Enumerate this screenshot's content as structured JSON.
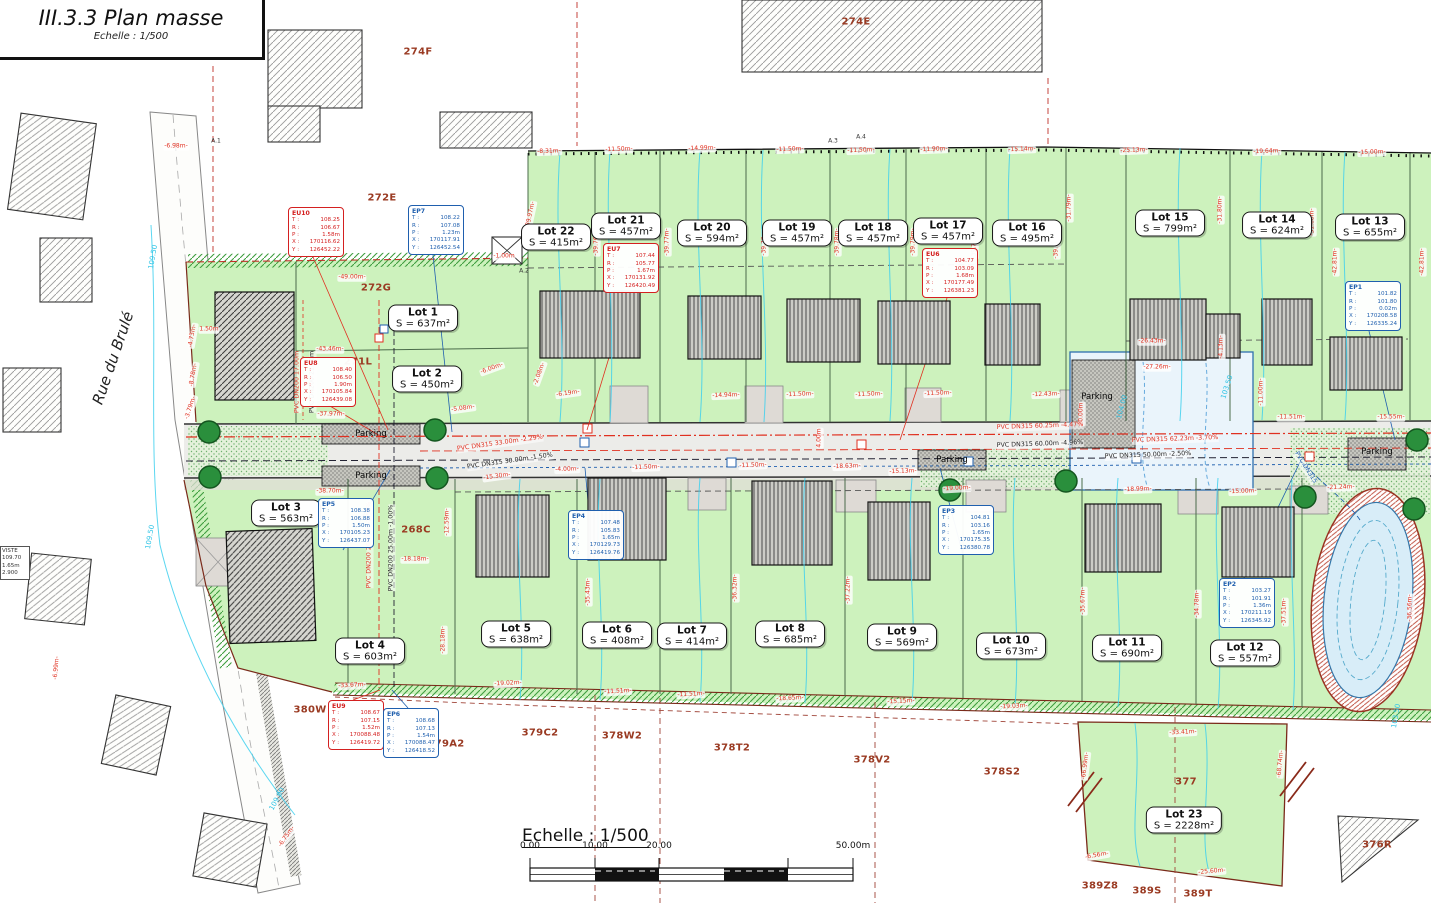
{
  "title_block": {
    "title": "III.3.3 Plan masse",
    "scale": "Echelle : 1/500"
  },
  "street": {
    "name": "Rue du Brulé"
  },
  "scale_bar": {
    "label": "Echelle : 1/500",
    "ticks": [
      {
        "t": "0.00",
        "x": 530,
        "y": 851
      },
      {
        "t": "10.00",
        "x": 595,
        "y": 851
      },
      {
        "t": "20.00",
        "x": 659,
        "y": 851
      },
      {
        "t": "50.00m",
        "x": 853,
        "y": 851
      }
    ]
  },
  "left_info_box": {
    "lines": [
      "VISTE",
      "109.70",
      "1.65m",
      "2.900"
    ]
  },
  "field_labels": [
    "T :",
    "R :",
    "P :",
    "X :",
    "Y :"
  ],
  "lots": [
    {
      "name": "Lot 1",
      "area": "S = 637m²",
      "x": 423,
      "y": 318
    },
    {
      "name": "Lot 2",
      "area": "S = 450m²",
      "x": 427,
      "y": 379
    },
    {
      "name": "Lot 3",
      "area": "S = 563m²",
      "x": 286,
      "y": 513
    },
    {
      "name": "Lot 4",
      "area": "S = 603m²",
      "x": 370,
      "y": 651
    },
    {
      "name": "Lot 5",
      "area": "S = 638m²",
      "x": 516,
      "y": 634
    },
    {
      "name": "Lot 6",
      "area": "S = 408m²",
      "x": 617,
      "y": 635
    },
    {
      "name": "Lot 7",
      "area": "S = 414m²",
      "x": 692,
      "y": 636
    },
    {
      "name": "Lot 8",
      "area": "S = 685m²",
      "x": 790,
      "y": 634
    },
    {
      "name": "Lot 9",
      "area": "S = 569m²",
      "x": 902,
      "y": 637
    },
    {
      "name": "Lot 10",
      "area": "S = 673m²",
      "x": 1011,
      "y": 646
    },
    {
      "name": "Lot 11",
      "area": "S = 690m²",
      "x": 1127,
      "y": 648
    },
    {
      "name": "Lot 12",
      "area": "S = 557m²",
      "x": 1245,
      "y": 653
    },
    {
      "name": "Lot 13",
      "area": "S = 655m²",
      "x": 1370,
      "y": 227
    },
    {
      "name": "Lot 14",
      "area": "S = 624m²",
      "x": 1277,
      "y": 225
    },
    {
      "name": "Lot 15",
      "area": "S = 799m²",
      "x": 1170,
      "y": 223
    },
    {
      "name": "Lot 16",
      "area": "S = 495m²",
      "x": 1027,
      "y": 233
    },
    {
      "name": "Lot 17",
      "area": "S = 457m²",
      "x": 948,
      "y": 231
    },
    {
      "name": "Lot 18",
      "area": "S = 457m²",
      "x": 873,
      "y": 233
    },
    {
      "name": "Lot 19",
      "area": "S = 457m²",
      "x": 797,
      "y": 233
    },
    {
      "name": "Lot 20",
      "area": "S = 594m²",
      "x": 712,
      "y": 233
    },
    {
      "name": "Lot 21",
      "area": "S = 457m²",
      "x": 626,
      "y": 226
    },
    {
      "name": "Lot 22",
      "area": "S = 415m²",
      "x": 556,
      "y": 237
    },
    {
      "name": "Lot 23",
      "area": "S = 2228m²",
      "x": 1184,
      "y": 820
    }
  ],
  "utility_boxes": [
    {
      "id": "EU10",
      "color": "#d42020",
      "x": 288,
      "y": 207,
      "t": "108.25",
      "r": "106.67",
      "p": "1.58m",
      "xc": "170116.62",
      "yc": "126452.22"
    },
    {
      "id": "EP7",
      "color": "#1f5fae",
      "x": 408,
      "y": 205,
      "t": "108.22",
      "r": "107.08",
      "p": "1.23m",
      "xc": "170117.91",
      "yc": "126452.54"
    },
    {
      "id": "EU8",
      "color": "#d42020",
      "x": 300,
      "y": 357,
      "t": "108.40",
      "r": "106.50",
      "p": "1.90m",
      "xc": "170105.84",
      "yc": "126439.08"
    },
    {
      "id": "EU7",
      "color": "#d42020",
      "x": 603,
      "y": 243,
      "t": "107.44",
      "r": "105.77",
      "p": "1.67m",
      "xc": "170131.92",
      "yc": "126420.49"
    },
    {
      "id": "EU6",
      "color": "#d42020",
      "x": 922,
      "y": 248,
      "t": "104.77",
      "r": "103.09",
      "p": "1.68m",
      "xc": "170177.49",
      "yc": "126381.23"
    },
    {
      "id": "EP5",
      "color": "#1f5fae",
      "x": 318,
      "y": 498,
      "t": "108.38",
      "r": "106.88",
      "p": "1.50m",
      "xc": "170105.23",
      "yc": "126437.07"
    },
    {
      "id": "EP4",
      "color": "#1f5fae",
      "x": 568,
      "y": 510,
      "t": "107.48",
      "r": "105.83",
      "p": "1.65m",
      "xc": "170129.73",
      "yc": "126419.76"
    },
    {
      "id": "EP3",
      "color": "#1f5fae",
      "x": 938,
      "y": 505,
      "t": "104.81",
      "r": "103.16",
      "p": "1.65m",
      "xc": "170175.35",
      "yc": "126380.78"
    },
    {
      "id": "EP2",
      "color": "#1f5fae",
      "x": 1219,
      "y": 578,
      "t": "103.27",
      "r": "101.91",
      "p": "1.36m",
      "xc": "170211.19",
      "yc": "126345.92"
    },
    {
      "id": "EP1",
      "color": "#1f5fae",
      "x": 1345,
      "y": 281,
      "t": "101.82",
      "r": "101.80",
      "p": "0.02m",
      "xc": "170208.58",
      "yc": "126335.24"
    },
    {
      "id": "EU9",
      "color": "#d42020",
      "x": 328,
      "y": 700,
      "t": "108.67",
      "r": "107.15",
      "p": "1.52m",
      "xc": "170088.48",
      "yc": "126419.72"
    },
    {
      "id": "EP6",
      "color": "#1f5fae",
      "x": 383,
      "y": 708,
      "t": "108.68",
      "r": "107.13",
      "p": "1.54m",
      "xc": "170088.47",
      "yc": "126418.52"
    }
  ],
  "parcels": [
    {
      "t": "274F",
      "x": 418,
      "y": 52
    },
    {
      "t": "274E",
      "x": 856,
      "y": 22
    },
    {
      "t": "272E",
      "x": 382,
      "y": 198
    },
    {
      "t": "272G",
      "x": 376,
      "y": 288
    },
    {
      "t": "271L",
      "x": 358,
      "y": 362
    },
    {
      "t": "268C",
      "x": 416,
      "y": 530
    },
    {
      "t": "380W",
      "x": 310,
      "y": 710
    },
    {
      "t": "379A2",
      "x": 446,
      "y": 744
    },
    {
      "t": "379C2",
      "x": 540,
      "y": 733
    },
    {
      "t": "378W2",
      "x": 622,
      "y": 736
    },
    {
      "t": "378T2",
      "x": 732,
      "y": 748
    },
    {
      "t": "378V2",
      "x": 872,
      "y": 760
    },
    {
      "t": "378S2",
      "x": 1002,
      "y": 772
    },
    {
      "t": "377",
      "x": 1186,
      "y": 782
    },
    {
      "t": "389Z8",
      "x": 1100,
      "y": 886
    },
    {
      "t": "389S",
      "x": 1147,
      "y": 891
    },
    {
      "t": "389T",
      "x": 1198,
      "y": 894
    },
    {
      "t": "376R",
      "x": 1377,
      "y": 845
    }
  ],
  "dimensions": [
    {
      "t": "-6.98m-",
      "x": 176,
      "y": 147,
      "r": 0
    },
    {
      "t": "-8.31m-",
      "x": 549,
      "y": 152,
      "r": -2
    },
    {
      "t": "-11.50m-",
      "x": 619,
      "y": 150,
      "r": -2
    },
    {
      "t": "-14.99m-",
      "x": 702,
      "y": 149,
      "r": -2
    },
    {
      "t": "-11.50m-",
      "x": 790,
      "y": 150,
      "r": -2
    },
    {
      "t": "-11.50m-",
      "x": 861,
      "y": 151,
      "r": -2
    },
    {
      "t": "-11.90m-",
      "x": 934,
      "y": 150,
      "r": -2
    },
    {
      "t": "-15.14m-",
      "x": 1022,
      "y": 150,
      "r": -2
    },
    {
      "t": "-25.13m-",
      "x": 1134,
      "y": 151,
      "r": -2
    },
    {
      "t": "-19.64m-",
      "x": 1267,
      "y": 152,
      "r": -2
    },
    {
      "t": "-15.00m-",
      "x": 1372,
      "y": 153,
      "r": -2
    },
    {
      "t": "-49.00m-",
      "x": 352,
      "y": 278,
      "r": 0
    },
    {
      "t": "-1.00m",
      "x": 504,
      "y": 257,
      "r": 0
    },
    {
      "t": "-43.46m-",
      "x": 330,
      "y": 350,
      "r": 0
    },
    {
      "t": "-37.97m-",
      "x": 331,
      "y": 415,
      "r": 0
    },
    {
      "t": "-38.70m-",
      "x": 330,
      "y": 492,
      "r": 0
    },
    {
      "t": "-33.67m-",
      "x": 352,
      "y": 686,
      "r": -3
    },
    {
      "t": "-18.18m-",
      "x": 415,
      "y": 560,
      "r": 0
    },
    {
      "t": "-12.59m-",
      "x": 448,
      "y": 522,
      "r": -90
    },
    {
      "t": "-28.18m-",
      "x": 444,
      "y": 640,
      "r": -90
    },
    {
      "t": "-15.30m-",
      "x": 497,
      "y": 477,
      "r": -8
    },
    {
      "t": "-4.00m-",
      "x": 567,
      "y": 470,
      "r": -2
    },
    {
      "t": "-11.50m-",
      "x": 646,
      "y": 468,
      "r": -2
    },
    {
      "t": "-11.50m-",
      "x": 753,
      "y": 466,
      "r": -2
    },
    {
      "t": "-18.63m-",
      "x": 847,
      "y": 467,
      "r": -2
    },
    {
      "t": "-15.13m-",
      "x": 903,
      "y": 472,
      "r": -2
    },
    {
      "t": "-19.00m-",
      "x": 957,
      "y": 489,
      "r": -3
    },
    {
      "t": "-18.99m-",
      "x": 1138,
      "y": 490,
      "r": -2
    },
    {
      "t": "-15.00m-",
      "x": 1243,
      "y": 492,
      "r": -2
    },
    {
      "t": "-21.24m-",
      "x": 1341,
      "y": 488,
      "r": -2
    },
    {
      "t": "-19.02m-",
      "x": 508,
      "y": 684,
      "r": -3
    },
    {
      "t": "-11.51m-",
      "x": 618,
      "y": 692,
      "r": -3
    },
    {
      "t": "-11.51m-",
      "x": 691,
      "y": 695,
      "r": -3
    },
    {
      "t": "-18.65m-",
      "x": 790,
      "y": 699,
      "r": -3
    },
    {
      "t": "-15.15m-",
      "x": 901,
      "y": 702,
      "r": -3
    },
    {
      "t": "-19.03m-",
      "x": 1014,
      "y": 707,
      "r": -3
    },
    {
      "t": "-33.41m-",
      "x": 1183,
      "y": 733,
      "r": -3
    },
    {
      "t": "-39.97m-",
      "x": 531,
      "y": 215,
      "r": -78
    },
    {
      "t": "-39.76m-",
      "x": 597,
      "y": 242,
      "r": -90
    },
    {
      "t": "-39.77m-",
      "x": 668,
      "y": 242,
      "r": -90
    },
    {
      "t": "-39.78m-",
      "x": 765,
      "y": 242,
      "r": -90
    },
    {
      "t": "-39.78m-",
      "x": 838,
      "y": 242,
      "r": -90
    },
    {
      "t": "-39.79m-",
      "x": 914,
      "y": 242,
      "r": -90
    },
    {
      "t": "-39.79m-",
      "x": 975,
      "y": 245,
      "r": -90
    },
    {
      "t": "-39.79m-",
      "x": 1057,
      "y": 245,
      "r": -90
    },
    {
      "t": "-31.79m-",
      "x": 1070,
      "y": 208,
      "r": -90
    },
    {
      "t": "-31.80m-",
      "x": 1221,
      "y": 210,
      "r": -90
    },
    {
      "t": "-31.68m-",
      "x": 1313,
      "y": 222,
      "r": -90
    },
    {
      "t": "-42.81m-",
      "x": 1336,
      "y": 262,
      "r": -90
    },
    {
      "t": "-42.81m-",
      "x": 1423,
      "y": 262,
      "r": -90
    },
    {
      "t": "-26.43m-",
      "x": 1152,
      "y": 342,
      "r": 0
    },
    {
      "t": "-27.26m-",
      "x": 1157,
      "y": 368,
      "r": 0
    },
    {
      "t": "-4.13m-",
      "x": 1222,
      "y": 347,
      "r": -90
    },
    {
      "t": "-11.00m-",
      "x": 1262,
      "y": 392,
      "r": -90
    },
    {
      "t": "-11.51m-",
      "x": 1291,
      "y": 418,
      "r": 0
    },
    {
      "t": "-15.55m-",
      "x": 1391,
      "y": 418,
      "r": 0
    },
    {
      "t": "20.00m",
      "x": 1082,
      "y": 414,
      "r": -90
    },
    {
      "t": "4.00m",
      "x": 820,
      "y": 438,
      "r": -90
    },
    {
      "t": "-6.00m-",
      "x": 492,
      "y": 369,
      "r": -20
    },
    {
      "t": "-6.19m-",
      "x": 568,
      "y": 394,
      "r": -8
    },
    {
      "t": "-5.08m-",
      "x": 463,
      "y": 409,
      "r": -8
    },
    {
      "t": "-2.08m-",
      "x": 540,
      "y": 374,
      "r": -70
    },
    {
      "t": "1.50m",
      "x": 209,
      "y": 330,
      "r": 0
    },
    {
      "t": "-4.73m-",
      "x": 193,
      "y": 336,
      "r": -80
    },
    {
      "t": "-8.78m-",
      "x": 194,
      "y": 375,
      "r": -80
    },
    {
      "t": "-3.79m-",
      "x": 191,
      "y": 408,
      "r": -72
    },
    {
      "t": "-6.99m-",
      "x": 57,
      "y": 668,
      "r": -85
    },
    {
      "t": "-6.75m-",
      "x": 287,
      "y": 837,
      "r": -55
    },
    {
      "t": "-66.99m-",
      "x": 1086,
      "y": 766,
      "r": -83
    },
    {
      "t": "-68.74m-",
      "x": 1281,
      "y": 764,
      "r": -85
    },
    {
      "t": "-6.56m-",
      "x": 1097,
      "y": 856,
      "r": -10
    },
    {
      "t": "-25.60m-",
      "x": 1212,
      "y": 872,
      "r": -5
    },
    {
      "t": "-35.43m-",
      "x": 589,
      "y": 592,
      "r": -90
    },
    {
      "t": "-36.32m-",
      "x": 736,
      "y": 588,
      "r": -90
    },
    {
      "t": "-37.22m-",
      "x": 849,
      "y": 590,
      "r": -90
    },
    {
      "t": "-35.67m-",
      "x": 1084,
      "y": 601,
      "r": -90
    },
    {
      "t": "-34.78m-",
      "x": 1198,
      "y": 604,
      "r": -90
    },
    {
      "t": "-37.51m-",
      "x": 1285,
      "y": 612,
      "r": -90
    },
    {
      "t": "-36.56m-",
      "x": 1411,
      "y": 608,
      "r": -90
    },
    {
      "t": "-14.94m-",
      "x": 726,
      "y": 396,
      "r": -2
    },
    {
      "t": "-11.50m-",
      "x": 800,
      "y": 395,
      "r": -2
    },
    {
      "t": "-11.50m-",
      "x": 869,
      "y": 395,
      "r": -2
    },
    {
      "t": "-11.50m-",
      "x": 938,
      "y": 394,
      "r": -2
    },
    {
      "t": "-12.43m-",
      "x": 1046,
      "y": 395,
      "r": -2
    }
  ],
  "pipe_labels": [
    {
      "t": "PVC DN315  33.00m  -2.29%",
      "x": 500,
      "y": 444,
      "r": -8,
      "c": "#e03020"
    },
    {
      "t": "PVC DN315  30.00m  -1.50%",
      "x": 510,
      "y": 462,
      "r": -8,
      "c": "#222222"
    },
    {
      "t": "PVC DN315  60.25m  -4.47%",
      "x": 1040,
      "y": 427,
      "r": -2,
      "c": "#e03020"
    },
    {
      "t": "PVC DN315  60.00m  -4.96%",
      "x": 1040,
      "y": 445,
      "r": -2,
      "c": "#222222"
    },
    {
      "t": "PVC DN315  62.23m  -3.70%",
      "x": 1175,
      "y": 440,
      "r": -2,
      "c": "#e03020"
    },
    {
      "t": "PVC DN315  50.00m  -2.50%",
      "x": 1148,
      "y": 456,
      "r": -2,
      "c": "#222222"
    },
    {
      "t": "PVC DN200  26.00m  -2.52%",
      "x": 370,
      "y": 545,
      "r": -90,
      "c": "#e03020"
    },
    {
      "t": "PVC DN200  25.00m  -1.00%",
      "x": 392,
      "y": 548,
      "r": -90,
      "c": "#222222"
    },
    {
      "t": "PVC DN200 17.00m",
      "x": 298,
      "y": 382,
      "r": -90,
      "c": "#e03020"
    },
    {
      "t": "PVC DN200 21.00m",
      "x": 313,
      "y": 382,
      "r": -90,
      "c": "#222222"
    },
    {
      "t": "PVC DN315",
      "x": 1305,
      "y": 468,
      "r": 58,
      "c": "#1f5fae"
    }
  ],
  "contour_labels": [
    {
      "t": "109.50",
      "x": 153,
      "y": 257,
      "r": -80
    },
    {
      "t": "109.50",
      "x": 150,
      "y": 537,
      "r": -80
    },
    {
      "t": "104.00",
      "x": 1122,
      "y": 407,
      "r": -75
    },
    {
      "t": "103.50",
      "x": 1227,
      "y": 387,
      "r": -72
    },
    {
      "t": "103.50",
      "x": 1396,
      "y": 716,
      "r": -80
    },
    {
      "t": "109.00",
      "x": 277,
      "y": 799,
      "r": -62
    }
  ],
  "parking_labels": [
    {
      "t": "Parking",
      "x": 371,
      "y": 434
    },
    {
      "t": "Parking",
      "x": 371,
      "y": 476
    },
    {
      "t": "Parking",
      "x": 952,
      "y": 460
    },
    {
      "t": "Parking",
      "x": 1097,
      "y": 397
    },
    {
      "t": "Parking",
      "x": 1377,
      "y": 452
    }
  ],
  "misc_labels": [
    {
      "t": "A.1",
      "x": 216,
      "y": 141
    },
    {
      "t": "A.2",
      "x": 524,
      "y": 271
    },
    {
      "t": "A.3",
      "x": 833,
      "y": 141
    },
    {
      "t": "A.4",
      "x": 861,
      "y": 137
    }
  ]
}
